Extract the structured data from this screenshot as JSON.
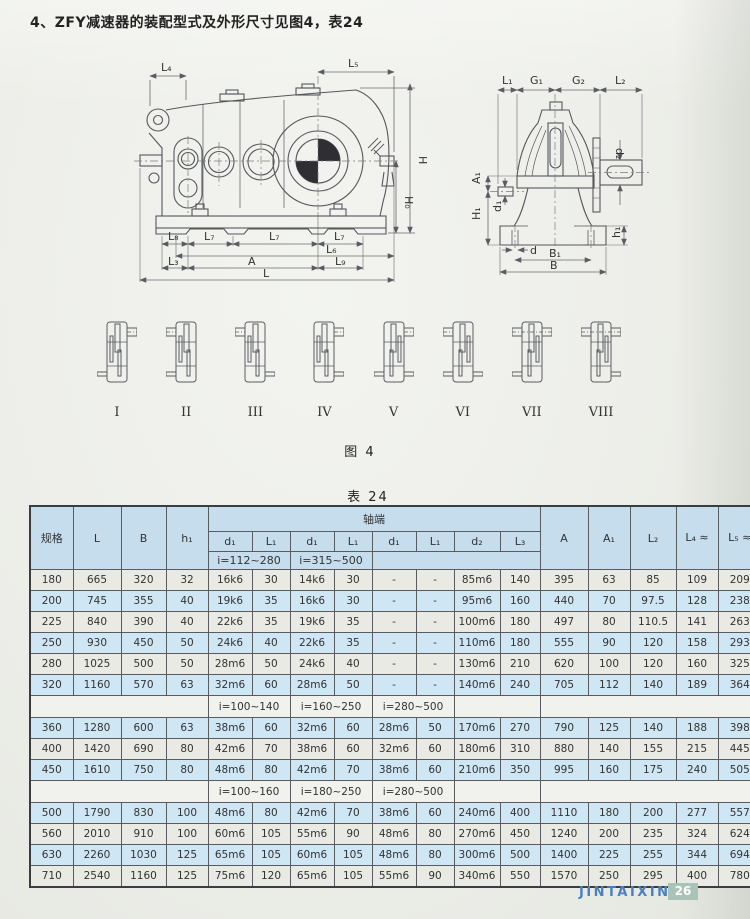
{
  "page": {
    "title": "4、ZFY减速器的装配型式及外形尺寸见图4，表24",
    "figure_caption": "图 4",
    "table_caption": "表 24",
    "footer_brand": "JINTAIXIN",
    "footer_page": "26"
  },
  "figure": {
    "side_labels": {
      "L4": "L₄",
      "L5": "L₅",
      "H": "H",
      "H0": "H₀",
      "L8": "L₈",
      "L7a": "L₇",
      "L7b": "L₇",
      "L7c": "L₇",
      "L6": "L₆",
      "L3": "L₃",
      "A": "A",
      "L9": "L₉",
      "L": "L"
    },
    "end_labels": {
      "L1": "L₁",
      "G1": "G₁",
      "G2": "G₂",
      "L2": "L₂",
      "d2": "d₂",
      "A1": "A₁",
      "H1": "H₁",
      "d1": "d₁",
      "h1": "h₁",
      "d": "d",
      "B1": "B₁",
      "B": "B"
    },
    "types": [
      "I",
      "II",
      "III",
      "IV",
      "V",
      "VI",
      "VII",
      "VIII"
    ]
  },
  "table": {
    "headers": {
      "spec": "规格",
      "L": "L",
      "B": "B",
      "h1": "h₁",
      "shaft_end": "轴端",
      "d1a": "d₁",
      "L1a": "L₁",
      "d1b": "d₁",
      "L1b": "L₁",
      "d1c": "d₁",
      "L1c": "L₁",
      "d2": "d₂",
      "L3": "L₃",
      "i1": "i=112~280",
      "i2": "i=315~500",
      "A": "A",
      "A1": "A₁",
      "L2": "L₂",
      "L4": "L₄\n≈",
      "L5": "L₅\n≈"
    },
    "sections": [
      {
        "type": "rows",
        "start_shade": "gray",
        "rows": [
          [
            "180",
            "665",
            "320",
            "32",
            "16k6",
            "30",
            "14k6",
            "30",
            "-",
            "-",
            "85m6",
            "140",
            "395",
            "63",
            "85",
            "109",
            "209"
          ],
          [
            "200",
            "745",
            "355",
            "40",
            "19k6",
            "35",
            "16k6",
            "30",
            "-",
            "-",
            "95m6",
            "160",
            "440",
            "70",
            "97.5",
            "128",
            "238"
          ],
          [
            "225",
            "840",
            "390",
            "40",
            "22k6",
            "35",
            "19k6",
            "35",
            "-",
            "-",
            "100m6",
            "180",
            "497",
            "80",
            "110.5",
            "141",
            "263"
          ],
          [
            "250",
            "930",
            "450",
            "50",
            "24k6",
            "40",
            "22k6",
            "35",
            "-",
            "-",
            "110m6",
            "180",
            "555",
            "90",
            "120",
            "158",
            "293"
          ],
          [
            "280",
            "1025",
            "500",
            "50",
            "28m6",
            "50",
            "24k6",
            "40",
            "-",
            "-",
            "130m6",
            "210",
            "620",
            "100",
            "120",
            "160",
            "325"
          ],
          [
            "320",
            "1160",
            "570",
            "63",
            "32m6",
            "60",
            "28m6",
            "50",
            "-",
            "-",
            "140m6",
            "240",
            "705",
            "112",
            "140",
            "189",
            "364"
          ]
        ]
      },
      {
        "type": "sub",
        "labels": [
          "i=100~140",
          "i=160~250",
          "i=280~500"
        ]
      },
      {
        "type": "rows",
        "start_shade": "blue",
        "rows": [
          [
            "360",
            "1280",
            "600",
            "63",
            "38m6",
            "60",
            "32m6",
            "60",
            "28m6",
            "50",
            "170m6",
            "270",
            "790",
            "125",
            "140",
            "188",
            "398"
          ],
          [
            "400",
            "1420",
            "690",
            "80",
            "42m6",
            "70",
            "38m6",
            "60",
            "32m6",
            "60",
            "180m6",
            "310",
            "880",
            "140",
            "155",
            "215",
            "445"
          ],
          [
            "450",
            "1610",
            "750",
            "80",
            "48m6",
            "80",
            "42m6",
            "70",
            "38m6",
            "60",
            "210m6",
            "350",
            "995",
            "160",
            "175",
            "240",
            "505"
          ]
        ]
      },
      {
        "type": "sub",
        "labels": [
          "i=100~160",
          "i=180~250",
          "i=280~500"
        ]
      },
      {
        "type": "rows",
        "start_shade": "blue",
        "rows": [
          [
            "500",
            "1790",
            "830",
            "100",
            "48m6",
            "80",
            "42m6",
            "70",
            "38m6",
            "60",
            "240m6",
            "400",
            "1110",
            "180",
            "200",
            "277",
            "557"
          ],
          [
            "560",
            "2010",
            "910",
            "100",
            "60m6",
            "105",
            "55m6",
            "90",
            "48m6",
            "80",
            "270m6",
            "450",
            "1240",
            "200",
            "235",
            "324",
            "624"
          ],
          [
            "630",
            "2260",
            "1030",
            "125",
            "65m6",
            "105",
            "60m6",
            "105",
            "48m6",
            "80",
            "300m6",
            "500",
            "1400",
            "225",
            "255",
            "344",
            "694"
          ],
          [
            "710",
            "2540",
            "1160",
            "125",
            "75m6",
            "120",
            "65m6",
            "105",
            "55m6",
            "90",
            "340m6",
            "550",
            "1570",
            "250",
            "295",
            "400",
            "780"
          ]
        ]
      }
    ]
  }
}
